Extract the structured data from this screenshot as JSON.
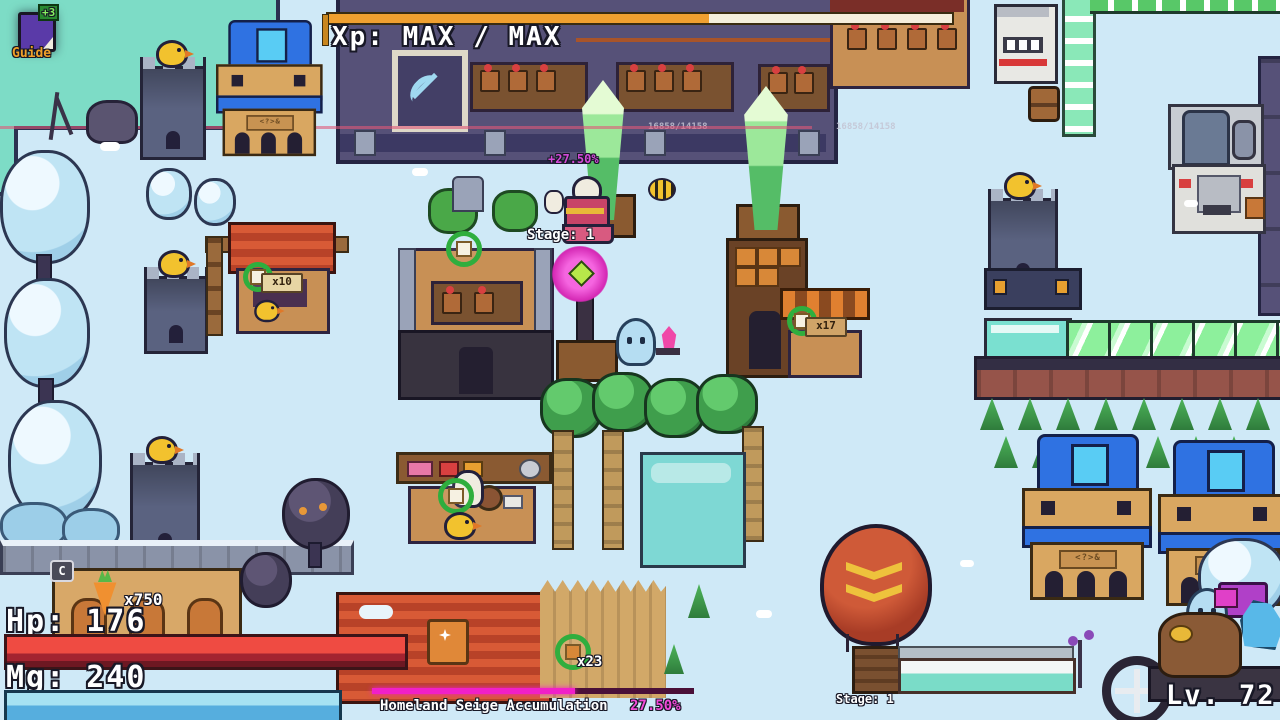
{
  "hud": {
    "guide_button": {
      "badge": "+3",
      "label": "Guide"
    },
    "xp_bar": {
      "label": "Xp: MAX / MAX",
      "fill_percent": 61,
      "fill_color": "#f0a030"
    },
    "hp": {
      "label": "Hp: 176",
      "fill_percent": 100,
      "fill_color": "#e8443c"
    },
    "mg": {
      "label": "Mg: 240",
      "fill_percent": 100,
      "fill_color": "#6cc0e8"
    },
    "level_label": "Lv. 72",
    "item_counter": {
      "key_hint": "C",
      "count": "x750"
    },
    "homeland_bar": {
      "label": "Homeland Seige Accumulation",
      "value": "27.50%",
      "fill_percent": 63,
      "fill_color": "#f020c8"
    }
  },
  "world": {
    "floating_gain_text": "+27.50%",
    "player_stage_label": "Stage: 1",
    "balloon_stage_label": "Stage: 1",
    "crystal_left_hp": "16858/14158",
    "crystal_right_hp": "16858/14158",
    "respawn_counters": {
      "stall_left": "x10",
      "stall_right": "x17",
      "palisade": "x23"
    }
  },
  "colors": {
    "snow_ground": "#cfe9f7",
    "teal_platform": "#7ddcc6",
    "xp_fill": "#f0a030",
    "hp_fill": "#e8443c",
    "mg_fill": "#6cc0e8",
    "homeland_fill": "#f020c8",
    "crystal_green": "#7ed87e",
    "balloon_red": "#b5432c",
    "house_roof_blue": "#2f72e2"
  }
}
